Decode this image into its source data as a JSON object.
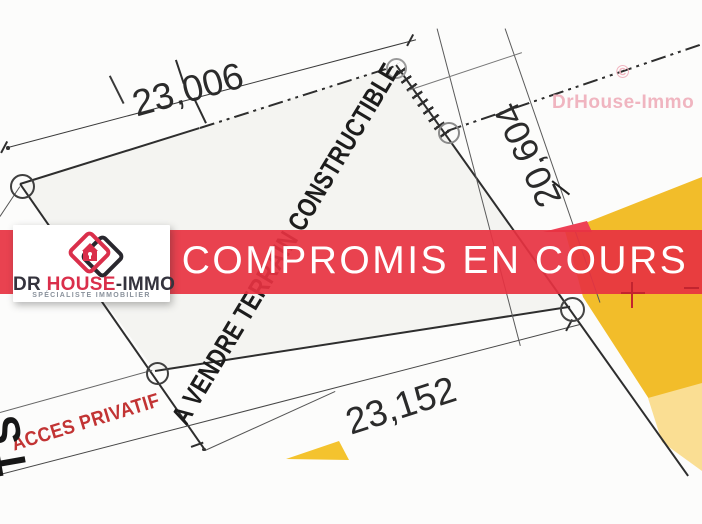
{
  "banner": {
    "label": "COMPROMIS EN COURS",
    "color": "#e73242"
  },
  "logo": {
    "brand_dr": "Dr",
    "brand_house": "House",
    "brand_immo": "-Immo",
    "subtitle": "Spécialiste Immobilier",
    "brand_red": "#da2f4b",
    "brand_dark": "#34333d"
  },
  "watermark": {
    "copyright": "©",
    "name": "DrHouse-Immo",
    "color": "#f0b5c0"
  },
  "plan": {
    "dimensions": {
      "top": "23,006",
      "bottom": "23,152",
      "right": "20,604"
    },
    "sale_label": "A VENDRE TERRAIN CONSTRUCTIBLE",
    "access_label": "ACCES PRIVATIF",
    "street_label_partial": "TS",
    "colors": {
      "zone_yellow": "#f2bd2a",
      "zone_yellow_light": "#fade93",
      "access_red": "#c23434",
      "survey_cross_red": "#c3242f"
    }
  }
}
